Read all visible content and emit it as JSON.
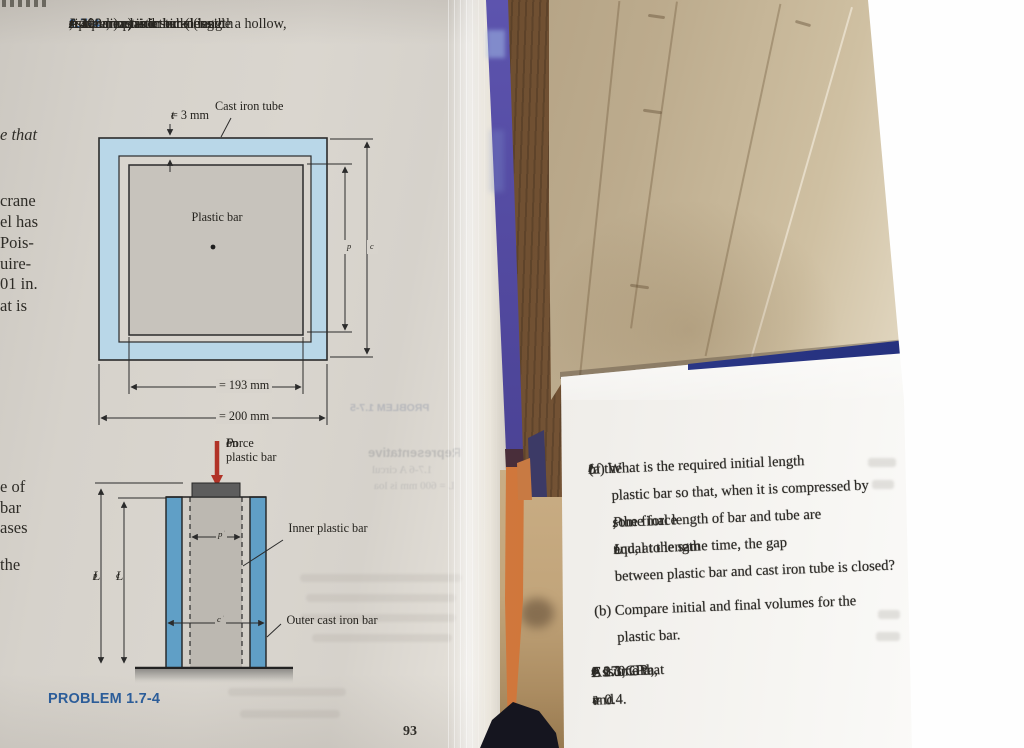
{
  "left_page": {
    "margin_fragments": [
      "e that",
      "crane",
      "el has",
      "Pois-",
      "uire-",
      "01 in.",
      "at is",
      "e of",
      "bar",
      "ases",
      "the"
    ],
    "problem": {
      "number": "1.7-4",
      "statement_lines": [
        [
          {
            "t": "1.7-4",
            "s": "num"
          },
          {
            "t": "A square plastic bar (length "
          },
          {
            "t": "L",
            "s": "var"
          },
          {
            "t": "p",
            "s": "sub"
          },
          {
            "t": ", side dimen-"
          }
        ],
        [
          {
            "t": "sion "
          },
          {
            "t": "s",
            "s": "var"
          },
          {
            "t": "p",
            "s": "sub"
          },
          {
            "t": " = 193 mm) is inserted inside a hollow,"
          }
        ],
        [
          {
            "t": "square, cast iron tube (length "
          },
          {
            "t": "L",
            "s": "var"
          },
          {
            "t": "c",
            "s": "sub"
          },
          {
            "t": " = 400 mm, side"
          }
        ],
        [
          {
            "t": "s",
            "s": "var"
          },
          {
            "t": "c",
            "s": "sub"
          },
          {
            "t": " = 200 mm, and thickness "
          },
          {
            "t": "t",
            "s": "var"
          },
          {
            "t": "c",
            "s": "sub"
          },
          {
            "t": " = 3 mm)."
          }
        ]
      ]
    },
    "figure1": {
      "tc_label": [
        {
          "t": "t",
          "s": "var"
        },
        {
          "t": "c",
          "s": "sub"
        },
        {
          "t": " = 3 mm"
        }
      ],
      "cast_iron_tube": "Cast iron tube",
      "plastic_bar": "Plastic bar",
      "sp_side": [
        {
          "t": "s",
          "s": "var"
        },
        {
          "t": "p",
          "s": "sub"
        }
      ],
      "sc_side": [
        {
          "t": "s",
          "s": "var"
        },
        {
          "t": "c",
          "s": "sub"
        }
      ],
      "sp_dim": [
        {
          "t": "s",
          "s": "var"
        },
        {
          "t": "p",
          "s": "sub"
        },
        {
          "t": " = 193 mm"
        }
      ],
      "sc_dim": [
        {
          "t": "s",
          "s": "var"
        },
        {
          "t": "c",
          "s": "sub"
        },
        {
          "t": " = 200 mm"
        }
      ]
    },
    "figure2": {
      "force_line1": [
        {
          "t": "Force "
        },
        {
          "t": "P",
          "s": "var"
        },
        {
          "t": " on"
        }
      ],
      "force_line2": "plastic bar",
      "sp_dim": [
        {
          "t": "S",
          "s": "var"
        },
        {
          "t": "p",
          "s": "sub"
        }
      ],
      "sc_dim": [
        {
          "t": "S",
          "s": "var"
        },
        {
          "t": "c",
          "s": "sub"
        }
      ],
      "inner_label": "Inner plastic bar",
      "outer_label": "Outer cast iron bar",
      "lp": [
        {
          "t": "L",
          "s": "var"
        },
        {
          "t": "p",
          "s": "sub"
        }
      ],
      "lc": [
        {
          "t": "L",
          "s": "var"
        },
        {
          "t": "c",
          "s": "sub"
        }
      ]
    },
    "caption": "PROBLEM 1.7-4",
    "page_number": "93",
    "ghost_texts": [
      "PROBLEM 1.7-5",
      "Representative",
      "1.7-6  A circul",
      "L = 600 mm is loa"
    ]
  },
  "right_page": {
    "lines": [
      [
        {
          "t": "(a) What is the required initial length "
        },
        {
          "t": "L",
          "s": "var"
        },
        {
          "t": "p",
          "s": "sub"
        },
        {
          "t": " of the"
        }
      ],
      [
        {
          "t": "plastic bar so that, when it is compressed by"
        }
      ],
      [
        {
          "t": "some force "
        },
        {
          "t": "P",
          "s": "var"
        },
        {
          "t": ", the final length of bar and tube are"
        }
      ],
      [
        {
          "t": "equal to length "
        },
        {
          "t": "L",
          "s": "var"
        },
        {
          "t": "c",
          "s": "sub"
        },
        {
          "t": " and, at the same time, the gap"
        }
      ],
      [
        {
          "t": "between plastic bar and cast iron tube is closed?"
        }
      ],
      [
        {
          "t": "(b) Compare initial and final volumes for the"
        }
      ],
      [
        {
          "t": "plastic bar."
        }
      ],
      [
        {
          "t": "Assume that "
        },
        {
          "t": "E",
          "s": "var"
        },
        {
          "t": "c",
          "s": "sub"
        },
        {
          "t": " = 170 GPa, "
        },
        {
          "t": "E",
          "s": "var"
        },
        {
          "t": "p",
          "s": "sub"
        },
        {
          "t": " = 2.1 GPa, "
        },
        {
          "t": "v",
          "s": "var"
        },
        {
          "t": "c",
          "s": "sub"
        },
        {
          "t": " = 0.3,"
        }
      ],
      [
        {
          "t": "and "
        },
        {
          "t": "v",
          "s": "var"
        },
        {
          "t": "p",
          "s": "sub"
        },
        {
          "t": " = 0.4."
        }
      ]
    ]
  },
  "colors": {
    "accent_blue": "#3a6fad",
    "caption_blue": "#2b5e9c",
    "figure_light_blue": "#b9d7e8",
    "figure_column_blue": "#609fc6",
    "arrow_red": "#b13327",
    "spine_purple": "#4f47a0",
    "spine_orange": "#d0763c"
  }
}
